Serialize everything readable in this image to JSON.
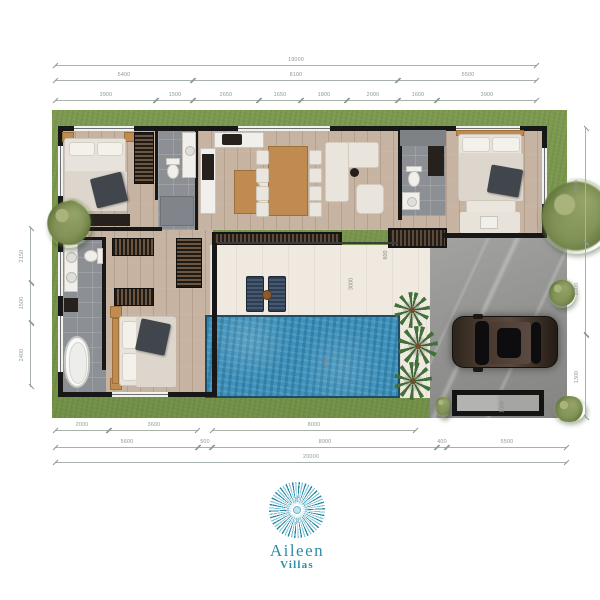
{
  "logo": {
    "name": "Aileen",
    "subtitle": "Villas",
    "color": "#2d8da6"
  },
  "colors": {
    "grass": "#7d9a51",
    "pool_water": "#3e92bc",
    "wood_floor": "#c6b3a2",
    "bath_tile": "#8c8f94",
    "terrace": "#efe9df",
    "driveway_stone": "#9a9a98",
    "wall": "#171717",
    "dimension": "#8d9894",
    "logo_teal": "#2d8da6"
  },
  "icons": {
    "logo_mark": "sunburst-icon"
  },
  "dimensions": {
    "top": [
      {
        "label": "19000",
        "x1": 55,
        "x2": 537,
        "y": 65
      },
      {
        "label": "5400",
        "x1": 55,
        "x2": 193,
        "y": 80
      },
      {
        "label": "8100",
        "x1": 193,
        "x2": 398,
        "y": 80
      },
      {
        "label": "5500",
        "x1": 398,
        "x2": 537,
        "y": 80
      },
      {
        "label": "3900",
        "x1": 55,
        "x2": 156,
        "y": 100
      },
      {
        "label": "1500",
        "x1": 156,
        "x2": 193,
        "y": 100
      },
      {
        "label": "2650",
        "x1": 193,
        "x2": 259,
        "y": 100
      },
      {
        "label": "1650",
        "x1": 259,
        "x2": 301,
        "y": 100
      },
      {
        "label": "1800",
        "x1": 301,
        "x2": 347,
        "y": 100
      },
      {
        "label": "2000",
        "x1": 347,
        "x2": 398,
        "y": 100
      },
      {
        "label": "1600",
        "x1": 398,
        "x2": 437,
        "y": 100
      },
      {
        "label": "3900",
        "x1": 437,
        "x2": 537,
        "y": 100
      }
    ],
    "bottom": [
      {
        "label": "2000",
        "x1": 55,
        "x2": 109,
        "y": 430
      },
      {
        "label": "3600",
        "x1": 109,
        "x2": 198,
        "y": 430
      },
      {
        "label": "8000",
        "x1": 212,
        "x2": 416,
        "y": 430
      },
      {
        "label": "5600",
        "x1": 55,
        "x2": 198,
        "y": 447
      },
      {
        "label": "500",
        "x1": 198,
        "x2": 212,
        "y": 447
      },
      {
        "label": "8900",
        "x1": 212,
        "x2": 437,
        "y": 447
      },
      {
        "label": "400",
        "x1": 437,
        "x2": 447,
        "y": 447
      },
      {
        "label": "5500",
        "x1": 447,
        "x2": 567,
        "y": 447
      },
      {
        "label": "20000",
        "x1": 55,
        "x2": 567,
        "y": 462
      }
    ],
    "left": [
      {
        "label": "2150",
        "y1": 228,
        "y2": 283,
        "x": 30
      },
      {
        "label": "1500",
        "y1": 283,
        "y2": 323,
        "x": 30
      },
      {
        "label": "2400",
        "y1": 323,
        "y2": 387,
        "x": 30
      }
    ],
    "right": [
      {
        "label": "5000",
        "y1": 128,
        "y2": 243,
        "x": 585
      },
      {
        "label": "5000",
        "y1": 243,
        "y2": 335,
        "x": 585
      },
      {
        "label": "1300",
        "y1": 335,
        "y2": 418,
        "x": 585
      }
    ],
    "interior": [
      {
        "label": "600",
        "x": 381,
        "y": 252,
        "vertical": true
      },
      {
        "label": "3000",
        "x": 345,
        "y": 281,
        "vertical": true
      },
      {
        "label": "3000",
        "x": 320,
        "y": 358,
        "vertical": true
      },
      {
        "label": "1000",
        "x": 496,
        "y": 404,
        "vertical": true
      }
    ]
  }
}
